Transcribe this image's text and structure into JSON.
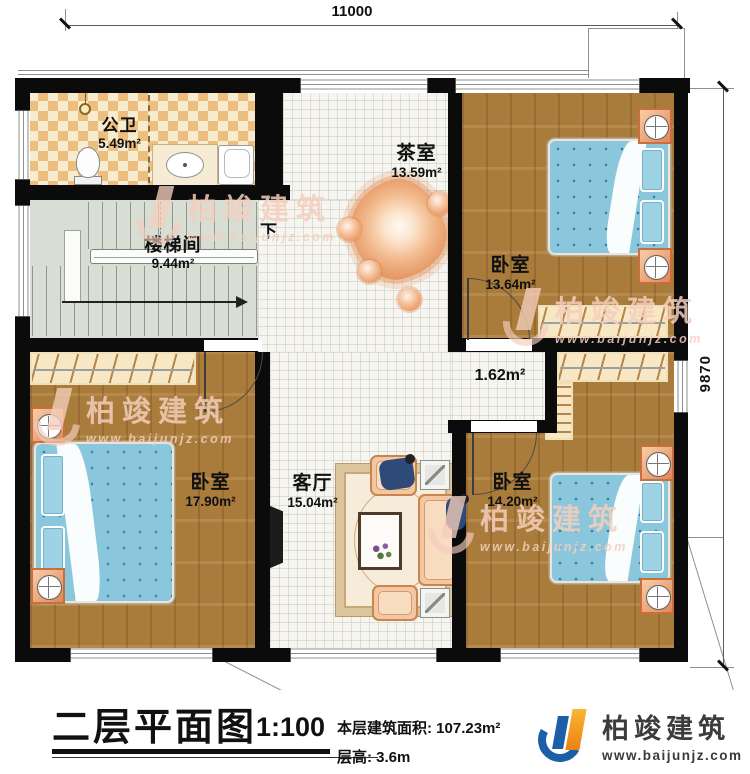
{
  "dimensions": {
    "width_mm": "11000",
    "height_mm": "9870"
  },
  "rooms": [
    {
      "name": "公卫",
      "area": "5.49m²"
    },
    {
      "name": "楼梯间",
      "area": "9.44m²"
    },
    {
      "name": "茶室",
      "area": "13.59m²"
    },
    {
      "name": "卧室",
      "area": "13.64m²"
    },
    {
      "name": "",
      "area": "1.62m²"
    },
    {
      "name": "卧室",
      "area": "17.90m²"
    },
    {
      "name": "客厅",
      "area": "15.04m²"
    },
    {
      "name": "卧室",
      "area": "14.20m²"
    }
  ],
  "stairs": {
    "down_label": "下"
  },
  "legend": {
    "title": "二层平面图",
    "scale": "1:100",
    "area_label": "本层建筑面积:",
    "area_value": "107.23m²",
    "height_label": "层高:",
    "height_value": "3.6m"
  },
  "branding": {
    "company": "柏竣建筑",
    "website": "www.baijunjz.com"
  },
  "watermark": {
    "company": "柏竣建筑",
    "website": "www.baijunjz.com"
  },
  "colors": {
    "wall": "#0b0b0b",
    "wood": "#a97c3c",
    "tile": "#f6f5f0",
    "stair_floor": "#d9ded4",
    "checker_dark": "#ecbf7e",
    "checker_light": "#f8ecd0",
    "bed_blue": "#8ac7dd",
    "furniture_orange": "#e08858",
    "logo_blue": "#1c5fa8",
    "logo_orange": "#f2930f"
  }
}
